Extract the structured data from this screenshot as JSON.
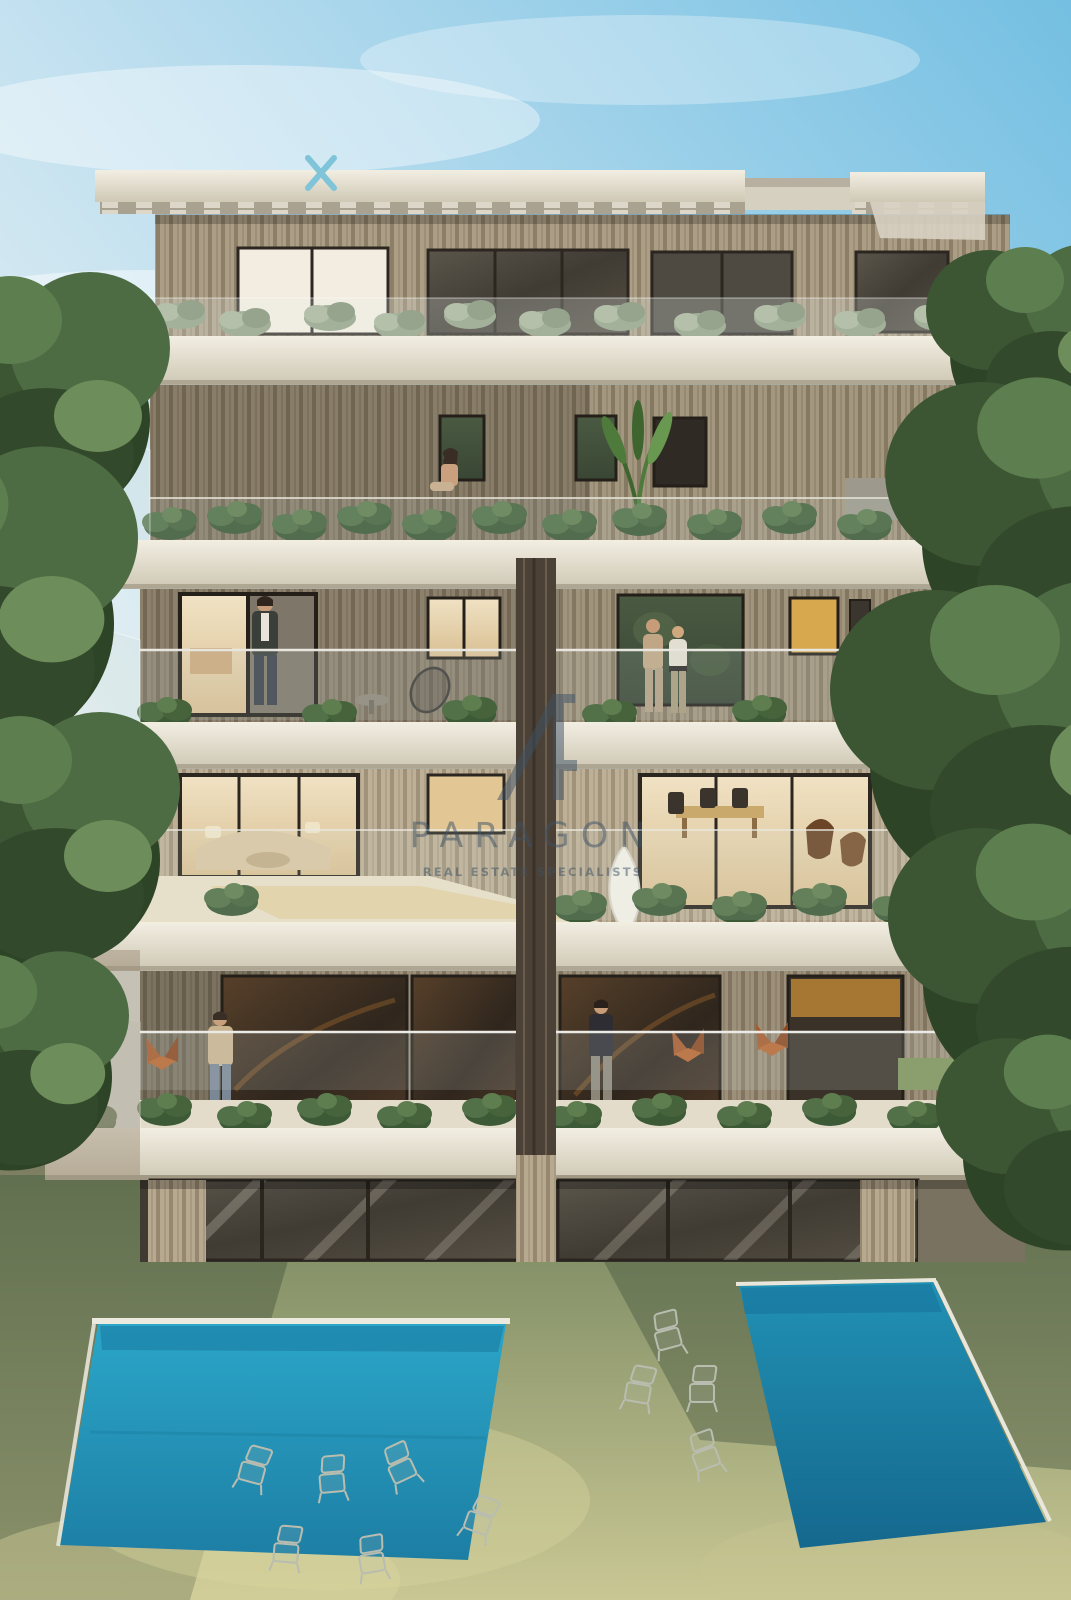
{
  "scene": {
    "type": "architectural-rendering",
    "description": "Rear elevation of a modern five-storey apartment building with wood-slat facade, planted balconies, glass balustrades, garden lawn and two swimming pools"
  },
  "watermark": {
    "name": "PARAGON",
    "tagline": "REAL ESTATE SPECIALISTS"
  },
  "colors": {
    "sky_top": "#74bfe2",
    "sky_mid": "#c3e1f0",
    "sky_horizon": "#f3f6f3",
    "slab_light": "#f2eee2",
    "slab_dark": "#cfc8b5",
    "wood": "#b7a98f",
    "wood_stripe": "#96876e",
    "glass_dark": "#45403a",
    "interior_warm": "#ecd9b4",
    "foliage_dark": "#2e4427",
    "foliage_mid": "#4e6c44",
    "foliage_light": "#6d8d5a",
    "lawn_top": "#6f805a",
    "lawn_bottom": "#c9c794",
    "pool_left_top": "#2ba6c8",
    "pool_left_bottom": "#1d7ea4",
    "pool_right_top": "#2191b4",
    "pool_right_bottom": "#15688e",
    "chair_rust": "#a5592a",
    "wire_chair": "#b9bdb0",
    "watermark": "#3d5166",
    "roof_logo": "#7fc4d8"
  }
}
